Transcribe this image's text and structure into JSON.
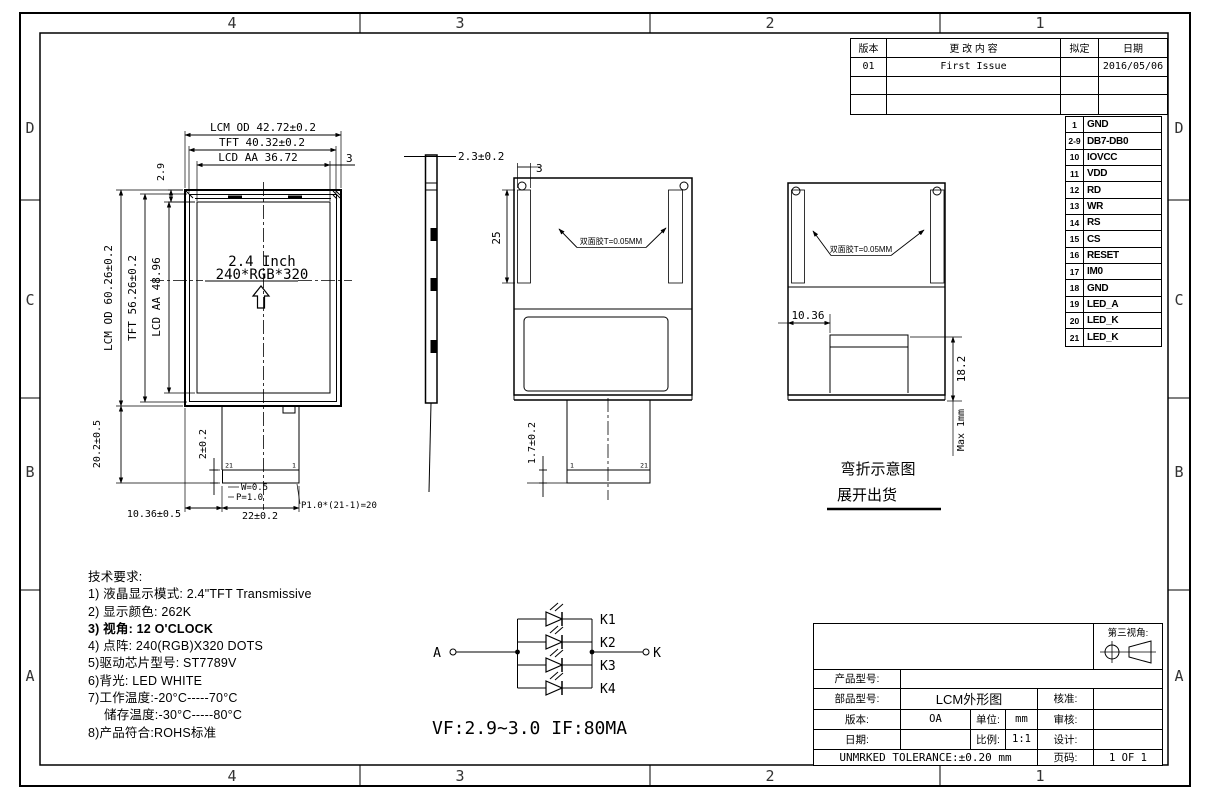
{
  "frame": {
    "cols": [
      "4",
      "3",
      "2",
      "1"
    ],
    "rows": [
      "D",
      "C",
      "B",
      "A"
    ]
  },
  "revision_table": {
    "headers": {
      "rev": "版本",
      "content": "更 改 内 容",
      "drafted": "拟定",
      "date": "日期"
    },
    "rows": [
      {
        "rev": "01",
        "content": "First Issue",
        "drafted": "",
        "date": "2016/05/06"
      },
      {
        "rev": "",
        "content": "",
        "drafted": "",
        "date": ""
      },
      {
        "rev": "",
        "content": "",
        "drafted": "",
        "date": ""
      }
    ]
  },
  "pin_table": {
    "rows": [
      {
        "pin": "1",
        "signal": "GND"
      },
      {
        "pin": "2-9",
        "signal": "DB7-DB0"
      },
      {
        "pin": "10",
        "signal": "IOVCC"
      },
      {
        "pin": "11",
        "signal": "VDD"
      },
      {
        "pin": "12",
        "signal": "RD"
      },
      {
        "pin": "13",
        "signal": "WR"
      },
      {
        "pin": "14",
        "signal": "RS"
      },
      {
        "pin": "15",
        "signal": "CS"
      },
      {
        "pin": "16",
        "signal": "RESET"
      },
      {
        "pin": "17",
        "signal": "IM0"
      },
      {
        "pin": "18",
        "signal": "GND"
      },
      {
        "pin": "19",
        "signal": "LED_A"
      },
      {
        "pin": "20",
        "signal": "LED_K"
      },
      {
        "pin": "21",
        "signal": "LED_K"
      }
    ]
  },
  "front_view": {
    "label_line1": "2.4 Inch",
    "label_line2": "240*RGB*320",
    "dims": {
      "lcm_od_w": "LCM OD 42.72±0.2",
      "tft_w": "TFT 40.32±0.2",
      "lcd_aa_w": "LCD AA 36.72",
      "edge_right": "3",
      "edge_top": "2.9",
      "lcm_od_h": "LCM OD 60.26±0.2",
      "tft_h": "TFT 56.26±0.2",
      "lcd_aa_h": "LCD AA 48.96",
      "fpc_len": "20.2±0.5",
      "conn_off": "2±0.2",
      "tooth_w": "W=0.5",
      "tooth_p": "P=1.0",
      "pitch": "P1.0*(21-1)=20",
      "fpc_off": "10.36±0.5",
      "fpc_w": "22±0.2",
      "pin_left": "21",
      "pin_right": "1"
    }
  },
  "side_view": {
    "thickness": "2.3±0.2"
  },
  "back_view": {
    "tape_w": "3",
    "tape_h": "25",
    "tape_label": "双面胶T=0.05MM",
    "conn_h": "1.7±0.2",
    "pin_left": "1",
    "pin_right": "21"
  },
  "unfold_view": {
    "tape_label": "双面胶T=0.05MM",
    "off": "10.36",
    "len": "18.2",
    "max": "Max 1mm"
  },
  "bend_note": {
    "line1": "弯折示意图",
    "line2": "展开出货"
  },
  "tech": {
    "title": "技术要求:",
    "items": [
      "1) 液晶显示模式: 2.4\"TFT Transmissive",
      "2) 显示颜色: 262K",
      "3) 视角: 12 O'CLOCK",
      "4) 点阵: 240(RGB)X320 DOTS",
      "5)驱动芯片型号: ST7789V",
      "6)背光: LED WHITE",
      "7)工作温度:-20°C-----70°C",
      "储存温度:-30°C-----80°C",
      "8)产品符合:ROHS标准"
    ]
  },
  "circuit": {
    "anode": "A",
    "cathode": "K",
    "leds": [
      "K1",
      "K2",
      "K3",
      "K4"
    ],
    "spec": "VF:2.9~3.0    IF:80MA"
  },
  "title_block": {
    "third_angle": "第三视角:",
    "product_model_label": "产品型号:",
    "part_model_label": "部品型号:",
    "part_model_value": "LCM外形图",
    "approve_label": "核准:",
    "version_label": "版本:",
    "version_value": "OA",
    "unit_label": "单位:",
    "unit_value": "mm",
    "review_label": "审核:",
    "date_label": "日期:",
    "scale_label": "比例:",
    "scale_value": "1:1",
    "design_label": "设计:",
    "tolerance": "UNMRKED TOLERANCE:±0.20 mm",
    "page_label": "页码:",
    "page_value": "1 OF 1"
  }
}
